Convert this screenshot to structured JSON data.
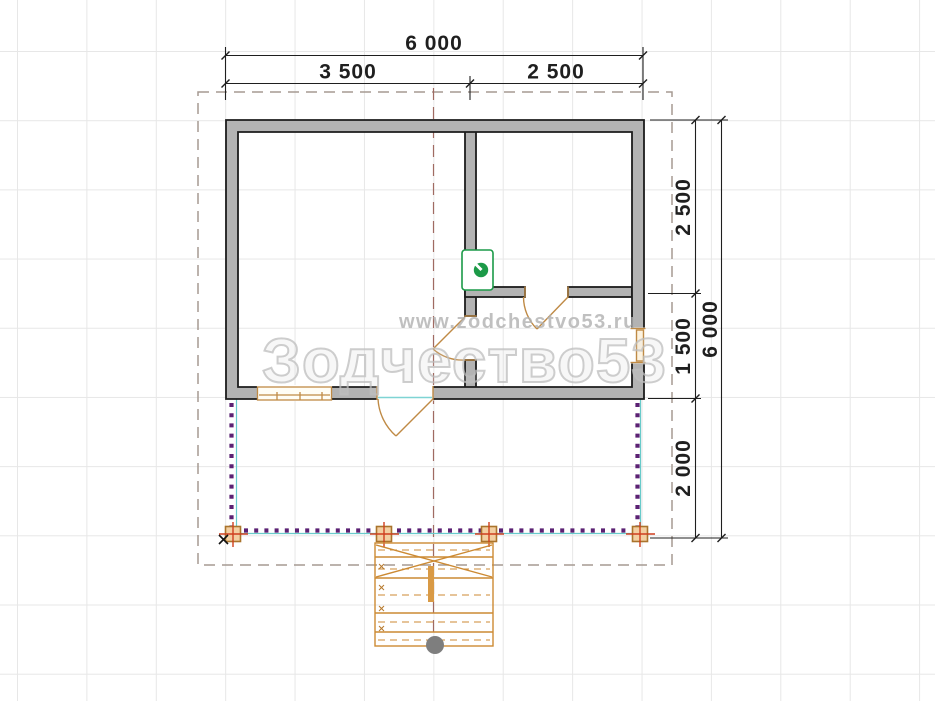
{
  "plan": {
    "type": "bathhouse-floor-plan",
    "watermark": {
      "big": "Зодчество53",
      "small": "www.zodchestvo53.ru"
    },
    "dimensions": {
      "top_total": "6 000",
      "top_left": "3 500",
      "top_right": "2 500",
      "right_seg1": "2 500",
      "right_seg2": "1 500",
      "right_seg3": "2 000",
      "right_total": "6 000"
    },
    "colors": {
      "wall_fill": "#b3b3b3",
      "wall_outline": "#1c1c1c",
      "joinery_tan": "#bf8a45",
      "stair_orange": "#cc8a33",
      "terrace_dots_purple": "#5b2173",
      "deck_edge_teal": "#68cbcb",
      "post_fill": "#f3cfa2",
      "post_cross_red": "#cf3f1f",
      "axis_red": "#a06a62",
      "roof_dash_gray": "#a59a92",
      "stove_green": "#1c9a48",
      "grid": "#e7e7e7"
    }
  }
}
